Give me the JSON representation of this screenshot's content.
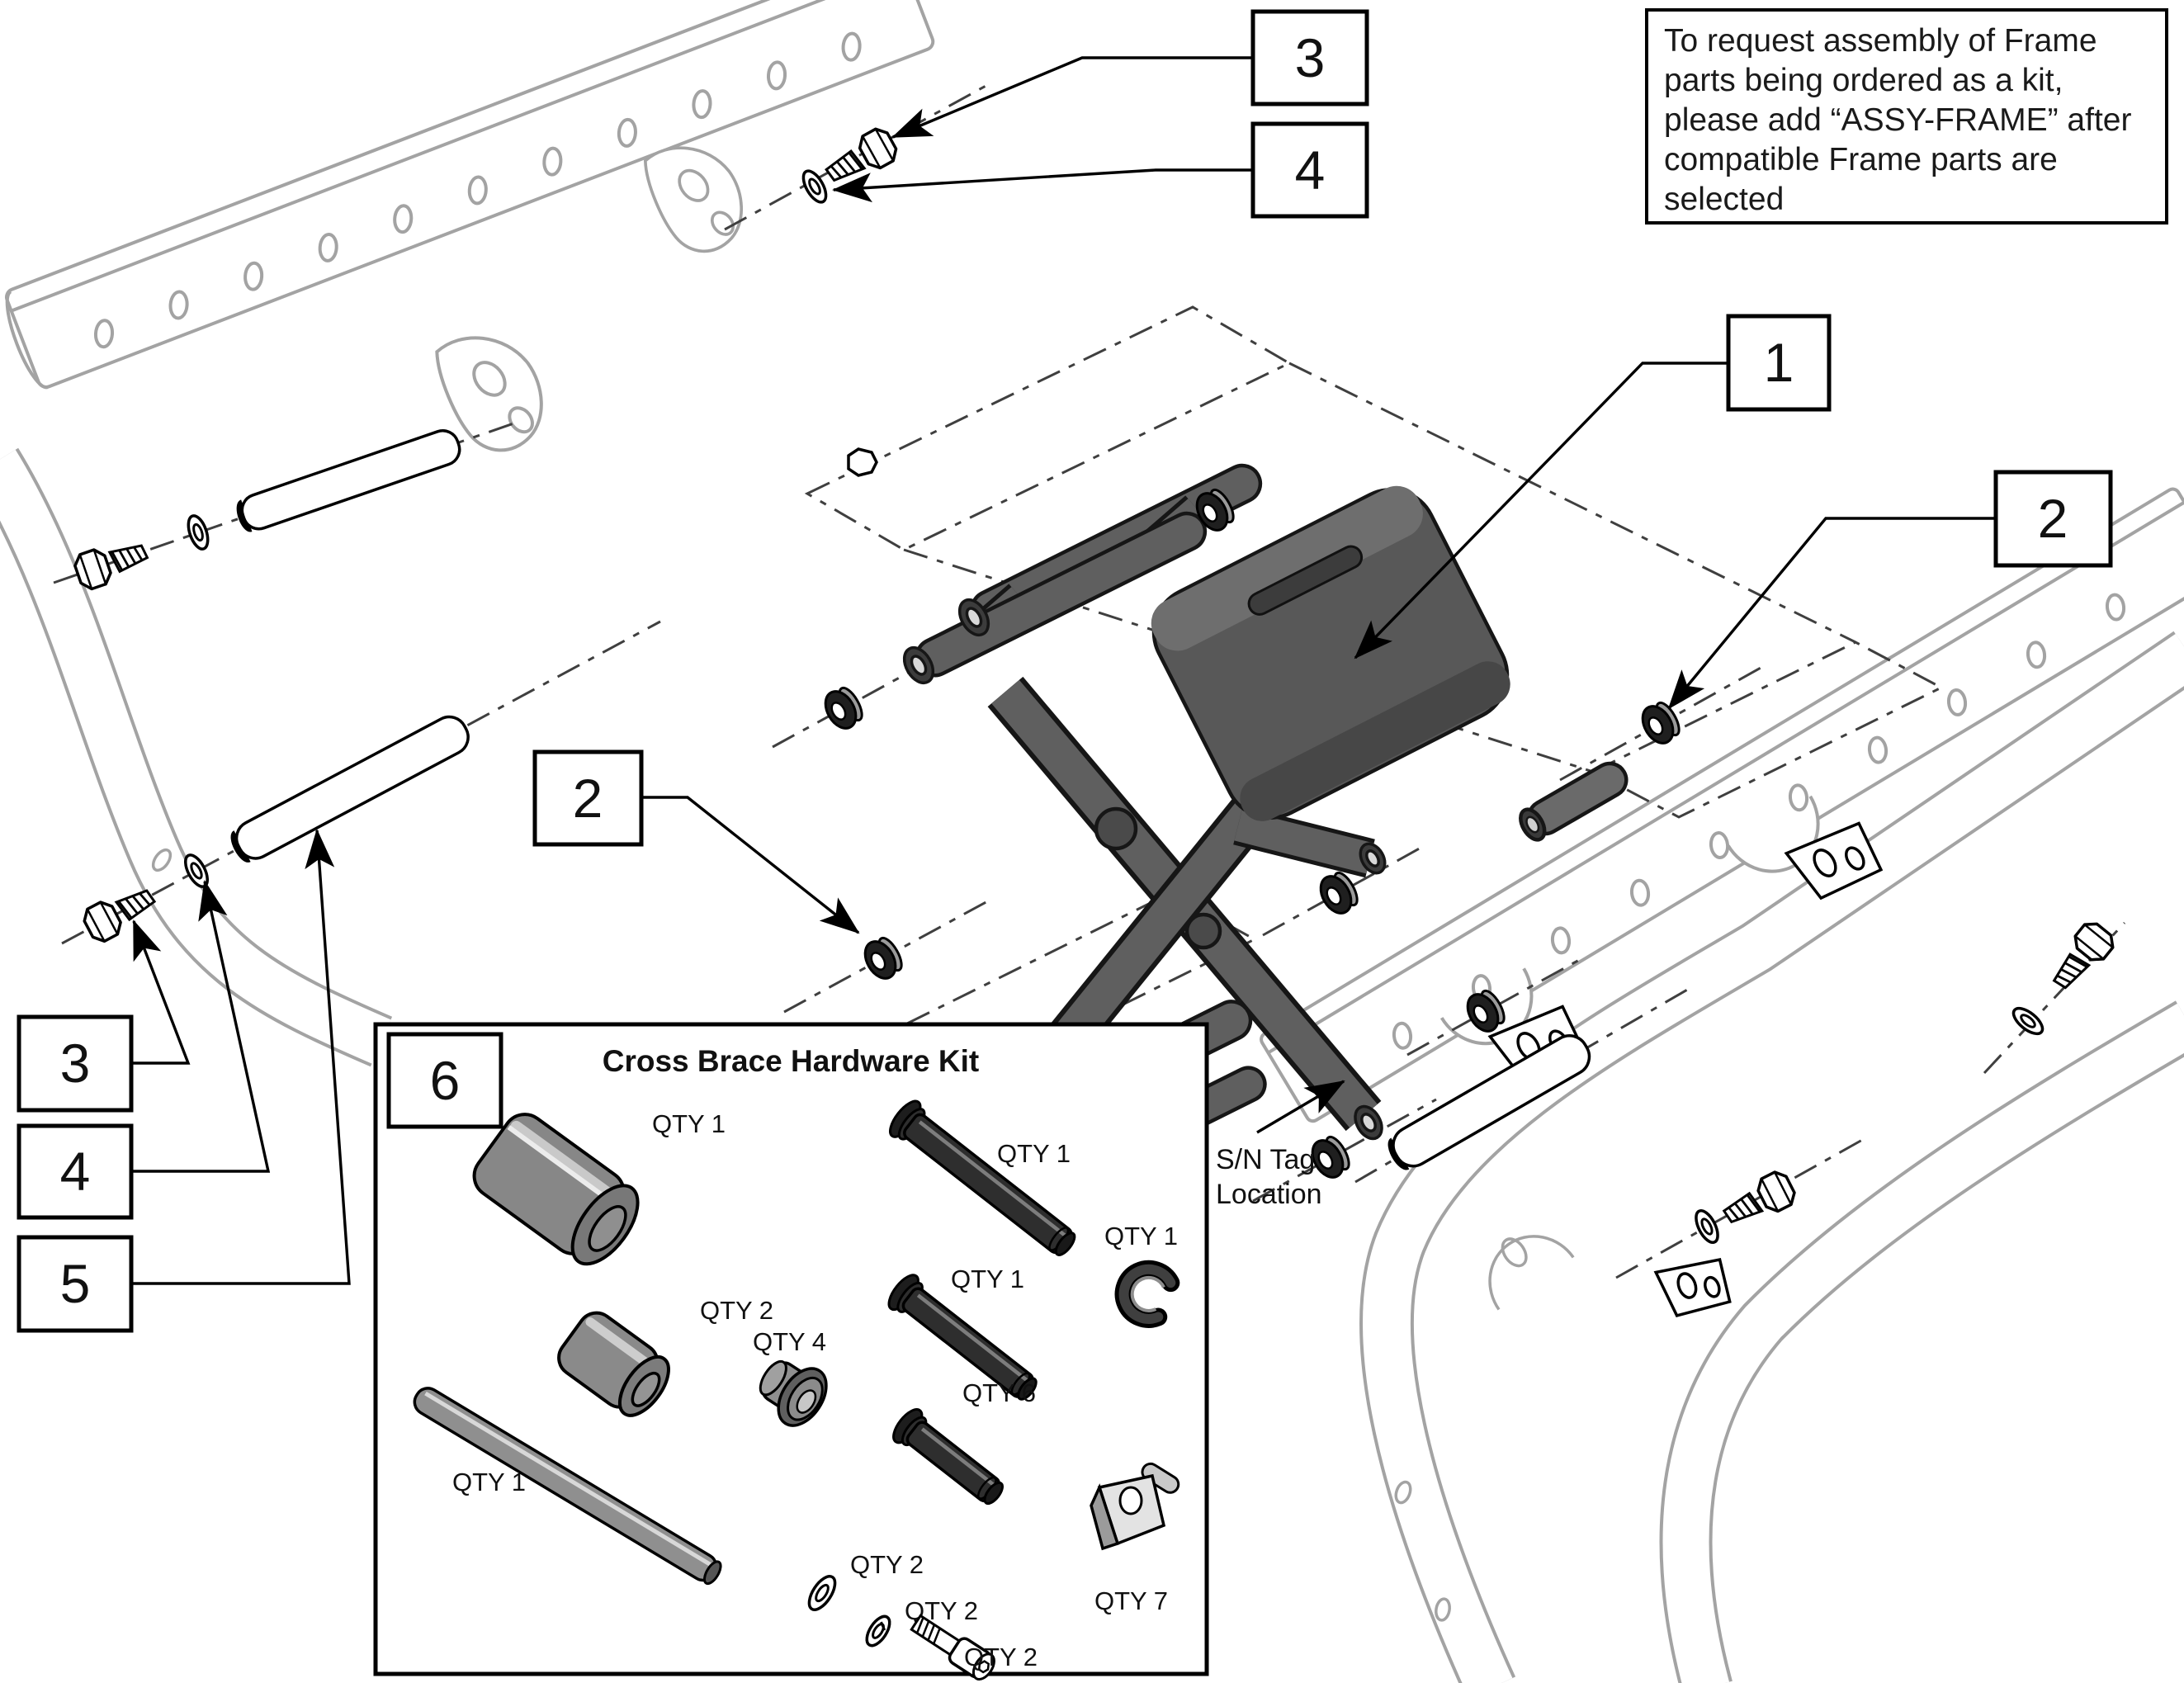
{
  "note": {
    "lines": [
      "To request assembly of Frame",
      "parts being ordered as a kit,",
      "please add “ASSY-FRAME” after",
      "compatible Frame parts are",
      "selected"
    ]
  },
  "callouts": {
    "top_3": "3",
    "top_4": "4",
    "right_1": "1",
    "right_2": "2",
    "mid_2": "2",
    "left_3": "3",
    "left_4": "4",
    "left_5": "5",
    "kit_6": "6"
  },
  "sn_tag": {
    "line1": "S/N Tag",
    "line2": "Location"
  },
  "kit": {
    "title": "Cross Brace Hardware Kit",
    "parts": [
      {
        "name": "large-spacer",
        "qty": "QTY 1"
      },
      {
        "name": "long-clevis-pin",
        "qty": "QTY 1"
      },
      {
        "name": "e-clip",
        "qty": "QTY 1"
      },
      {
        "name": "medium-clevis-pin",
        "qty": "QTY 1"
      },
      {
        "name": "medium-spacer",
        "qty": "QTY 2"
      },
      {
        "name": "cross-tube",
        "qty": "QTY 1"
      },
      {
        "name": "flanged-bushing",
        "qty": "QTY 4"
      },
      {
        "name": "small-clevis-pin",
        "qty": "QTY 6"
      },
      {
        "name": "retainer-clip",
        "qty": "QTY 7"
      },
      {
        "name": "flat-washer",
        "qty": "QTY 2"
      },
      {
        "name": "lock-washer",
        "qty": "QTY 2"
      },
      {
        "name": "socket-screw",
        "qty": "QTY 2"
      }
    ]
  },
  "colors": {
    "outline": "#000000",
    "frame_gray": "#a3a3a3",
    "dash_gray": "#3f3f3f",
    "brace_fill": "#5f5f5f",
    "brace_dark": "#3c3c3c",
    "spacer_gray": "#878787",
    "pin_dark": "#2e2e2e",
    "grommet_flange": "#9a9a9a",
    "grommet_body": "#1f1f1f",
    "background": "#ffffff"
  }
}
